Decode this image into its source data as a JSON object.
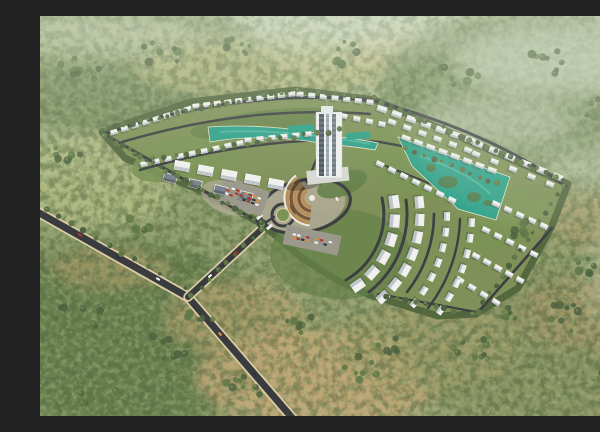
{
  "meta": {
    "description": "Aerial 3D rendering of a master-planned residential compound with curved rows of white villas and apartment blocks, a central high-rise tower, teal lagoon pools, a circular plaza with amphitheater, parking lots and an entrance road, surrounded by olive-green forest and tan clearings"
  },
  "palette": {
    "bg_top": "#c6d0b2",
    "bg_mid": "#8f9e6e",
    "bg_bot": "#99a172",
    "forest_dark": "#54683f",
    "forest_mid": "#74895a",
    "forest_light": "#a9b985",
    "mist": "#dde5d2",
    "road": "#393b3e",
    "road_int": "#3d3f42",
    "road_shoulder": "#dbcda6",
    "plot_base": "#7f9158",
    "lawn": "#65814a",
    "lawn_light": "#7a9455",
    "water": "#2da189",
    "island": "#4c7d4e",
    "water_streak": "#7fd0bd",
    "building": "#f0f1ee",
    "building_face": "#b9c0c8",
    "building_shadow": "#2e3430",
    "roof_gray": "#79828c",
    "roof_face": "#596169",
    "paving": "#b3ac99",
    "parking_asphalt": "#9b998c",
    "amphi_tan": "#b98e5a",
    "amphi_dark": "#7a5836",
    "amphi_rim": "#eeece0",
    "tower_light": "#eef1f2",
    "tower_dark": "#39414c",
    "tower_mid": "#8fa0ac",
    "tree_a": "#4d6340",
    "tree_b": "#5d7747",
    "tree_hi": "#7d9458",
    "stripe": "#b89a68",
    "cars": [
      "#f2f2f0",
      "#2e3338",
      "#b23427",
      "#d98f35",
      "#8a9096"
    ]
  },
  "scene": {
    "patches": [
      {
        "cx": 90,
        "cy": 55,
        "rx": 150,
        "ry": 65,
        "fill": "#74895a",
        "op": 0.9
      },
      {
        "cx": 55,
        "cy": 22,
        "rx": 130,
        "ry": 26,
        "fill": "#b7c093",
        "op": 0.65
      },
      {
        "cx": 225,
        "cy": 52,
        "rx": 130,
        "ry": 30,
        "fill": "#bdbd83",
        "op": 0.8
      },
      {
        "cx": 385,
        "cy": 38,
        "rx": 85,
        "ry": 22,
        "fill": "#c9bd84",
        "op": 0.6
      },
      {
        "cx": 490,
        "cy": 70,
        "rx": 150,
        "ry": 75,
        "fill": "#7d9263",
        "op": 0.9
      },
      {
        "cx": 55,
        "cy": 165,
        "rx": 85,
        "ry": 48,
        "fill": "#b5be85",
        "op": 0.85
      },
      {
        "cx": 85,
        "cy": 320,
        "rx": 150,
        "ry": 95,
        "fill": "#68804f",
        "op": 0.95
      },
      {
        "cx": 70,
        "cy": 252,
        "rx": 60,
        "ry": 22,
        "fill": "#c2a26e",
        "op": 0.5
      },
      {
        "cx": 280,
        "cy": 362,
        "rx": 125,
        "ry": 48,
        "fill": "#c6a877",
        "op": 0.85
      },
      {
        "cx": 195,
        "cy": 302,
        "rx": 70,
        "ry": 38,
        "fill": "#c9a874",
        "op": 0.6
      },
      {
        "cx": 500,
        "cy": 330,
        "rx": 135,
        "ry": 80,
        "fill": "#8a9364",
        "op": 0.85
      },
      {
        "cx": 548,
        "cy": 298,
        "rx": 70,
        "ry": 36,
        "fill": "#b59a6d",
        "op": 0.5
      },
      {
        "cx": 565,
        "cy": 205,
        "rx": 60,
        "ry": 32,
        "fill": "#b99a6a",
        "op": 0.45
      },
      {
        "cx": 295,
        "cy": 248,
        "rx": 60,
        "ry": 26,
        "fill": "#c2a26e",
        "op": 0.55
      },
      {
        "cx": 470,
        "cy": 230,
        "rx": 60,
        "ry": 30,
        "fill": "#9aa36f",
        "op": 0.6
      },
      {
        "cx": 390,
        "cy": 330,
        "rx": 90,
        "ry": 45,
        "fill": "#a5a06b",
        "op": 0.6
      }
    ],
    "mist": [
      {
        "cx": 520,
        "cy": 42,
        "rx": 110,
        "ry": 38,
        "op": 0.5
      },
      {
        "cx": 455,
        "cy": 108,
        "rx": 80,
        "ry": 26,
        "op": 0.38
      },
      {
        "cx": 560,
        "cy": 150,
        "rx": 60,
        "ry": 22,
        "op": 0.3
      },
      {
        "cx": 300,
        "cy": 20,
        "rx": 120,
        "ry": 22,
        "op": 0.35
      },
      {
        "cx": 80,
        "cy": 18,
        "rx": 90,
        "ry": 16,
        "op": 0.3
      },
      {
        "cx": 585,
        "cy": 260,
        "rx": 40,
        "ry": 60,
        "op": 0.25
      }
    ],
    "stripes": {
      "x1": 198,
      "y1": 334,
      "x2": 316,
      "y2": 356,
      "n": 12,
      "dx": 14,
      "dy": 38
    },
    "roads_external": [
      {
        "d": "M-6,194 L148,281 L254,404",
        "w": 7
      },
      {
        "d": "M148,281 L226,209",
        "w": 6
      }
    ],
    "plot": {
      "points": [
        [
          62,
          116
        ],
        [
          150,
          86
        ],
        [
          255,
          74
        ],
        [
          335,
          84
        ],
        [
          455,
          136
        ],
        [
          528,
          168
        ],
        [
          512,
          210
        ],
        [
          478,
          272
        ],
        [
          436,
          298
        ],
        [
          398,
          300
        ],
        [
          330,
          279
        ],
        [
          300,
          266
        ],
        [
          262,
          242
        ],
        [
          222,
          208
        ],
        [
          155,
          172
        ],
        [
          120,
          158
        ],
        [
          85,
          142
        ]
      ]
    },
    "tints": [
      {
        "cx": 150,
        "cy": 140,
        "rx": 60,
        "ry": 22,
        "rot": -15,
        "fill": "lawn_light",
        "op": 0.9
      },
      {
        "cx": 230,
        "cy": 108,
        "rx": 80,
        "ry": 14,
        "rot": -6,
        "fill": "lawn",
        "op": 0.8
      },
      {
        "cx": 380,
        "cy": 150,
        "rx": 70,
        "ry": 30,
        "rot": 20,
        "fill": "lawn_light",
        "op": 0.8
      },
      {
        "cx": 300,
        "cy": 238,
        "rx": 70,
        "ry": 45,
        "rot": 0,
        "fill": "lawn",
        "op": 0.7
      },
      {
        "cx": 455,
        "cy": 205,
        "rx": 45,
        "ry": 28,
        "rot": -35,
        "fill": "lawn_light",
        "op": 0.7
      },
      {
        "cx": 262,
        "cy": 190,
        "rx": 44,
        "ry": 26,
        "rot": -12,
        "fill": "paving",
        "op": 0.85
      },
      {
        "cx": 190,
        "cy": 182,
        "rx": 30,
        "ry": 16,
        "rot": 18,
        "fill": "paving",
        "op": 0.7
      },
      {
        "cx": 302,
        "cy": 168,
        "rx": 26,
        "ry": 12,
        "rot": -20,
        "fill": "lawn",
        "op": 0.9
      }
    ],
    "roads_internal": [
      {
        "type": "path",
        "d": "M64,118 C150,88 240,76 332,84 C420,108 480,138 526,170",
        "w": 3
      },
      {
        "type": "path",
        "d": "M82,126 C170,100 250,92 330,98",
        "w": 2.4
      },
      {
        "type": "path",
        "d": "M100,154 C190,128 272,120 340,126 C390,134 440,152 468,166",
        "w": 2.4
      },
      {
        "type": "path",
        "d": "M222,208 L64,118",
        "w": 3
      },
      {
        "type": "ellipse",
        "cx": 265,
        "cy": 190,
        "rx": 46,
        "ry": 26,
        "rot": -12,
        "w": 3.2
      },
      {
        "type": "circle",
        "cx": 243,
        "cy": 199,
        "r": 11,
        "w": 3
      },
      {
        "type": "path",
        "d": "M225,207 L234,201",
        "w": 2.4
      },
      {
        "type": "path",
        "d": "M267,166 L277,142",
        "w": 2.4
      },
      {
        "type": "path",
        "d": "M342,182 A76,76 0 0 1 306,264",
        "w": 3
      },
      {
        "type": "path",
        "d": "M366,184 A99,99 0 0 1 329,276",
        "w": 3
      },
      {
        "type": "path",
        "d": "M394,198 A126,126 0 0 1 367,276",
        "w": 2.6
      },
      {
        "type": "path",
        "d": "M420,203 A152,152 0 0 1 388,292",
        "w": 2.4
      },
      {
        "type": "path",
        "d": "M360,124 L466,162",
        "w": 2.2
      },
      {
        "type": "path",
        "d": "M346,150 L446,190",
        "w": 2.2
      },
      {
        "type": "path",
        "d": "M512,212 L440,294",
        "w": 2.6
      },
      {
        "type": "path",
        "d": "M436,296 L338,278",
        "w": 2.2
      }
    ],
    "lagoons": [
      {
        "d": "M168,111 C210,108 252,112 280,118 C302,122 322,123 338,127 L335,134 C312,130 292,129 274,126 C242,121 202,120 170,126 Z"
      },
      {
        "d": "M358,121 L470,161 L456,204 L418,193 L372,150 Z"
      }
    ],
    "islands": [
      [
        408,
        166,
        10,
        6
      ],
      [
        434,
        181,
        7,
        5
      ],
      [
        391,
        152,
        5,
        4
      ],
      [
        448,
        187,
        5,
        3
      ]
    ],
    "streaks": [
      {
        "d": "M180,116 C230,113 290,120 330,128"
      },
      {
        "d": "M380,140 C410,150 435,162 450,178"
      }
    ],
    "pools": [
      [
        248,
        110,
        26,
        7,
        -4
      ],
      [
        306,
        117,
        24,
        7,
        -4
      ]
    ],
    "amphitheater": {
      "cx": 272,
      "cy": 182,
      "radii": [
        9,
        13,
        17,
        21,
        25
      ],
      "rim": 27.5,
      "a1": 95,
      "a2": 235
    },
    "roundabout": {
      "cx": 243,
      "cy": 199,
      "r_outer": 11,
      "r_inner": 6.5
    },
    "gate": {
      "rects": [
        [
          216,
          202,
          7,
          3,
          -40
        ],
        [
          226,
          212,
          7,
          3,
          -40
        ]
      ],
      "circle": [
        222,
        208,
        4
      ]
    },
    "parkings": [
      {
        "cx": 203,
        "cy": 180,
        "w": 48,
        "h": 26,
        "rot": 20,
        "rows": 3,
        "cols": 8
      },
      {
        "cx": 272,
        "cy": 224,
        "w": 56,
        "h": 20,
        "rot": 12,
        "rows": 2,
        "cols": 9
      }
    ],
    "building_rows": [
      {
        "x1": 74,
        "y1": 116,
        "x2": 148,
        "y2": 93,
        "n": 8,
        "w": 7,
        "h": 5
      },
      {
        "x1": 156,
        "y1": 90,
        "x2": 252,
        "y2": 78,
        "n": 10,
        "w": 7,
        "h": 5
      },
      {
        "x1": 260,
        "y1": 78,
        "x2": 330,
        "y2": 86,
        "n": 7,
        "w": 7,
        "h": 5
      },
      {
        "x1": 304,
        "y1": 100,
        "x2": 342,
        "y2": 108,
        "n": 4,
        "w": 7,
        "h": 5
      },
      {
        "x1": 342,
        "y1": 93,
        "x2": 430,
        "y2": 124,
        "n": 7,
        "w": 10,
        "h": 6
      },
      {
        "x1": 438,
        "y1": 128,
        "x2": 518,
        "y2": 161,
        "n": 6,
        "w": 10,
        "h": 6
      },
      {
        "x1": 352,
        "y1": 106,
        "x2": 428,
        "y2": 134,
        "n": 6,
        "w": 8,
        "h": 5
      },
      {
        "x1": 436,
        "y1": 138,
        "x2": 510,
        "y2": 168,
        "n": 5,
        "w": 8,
        "h": 5
      },
      {
        "x1": 104,
        "y1": 148,
        "x2": 200,
        "y2": 127,
        "n": 9,
        "w": 7,
        "h": 5
      },
      {
        "x1": 208,
        "y1": 124,
        "x2": 268,
        "y2": 118,
        "n": 6,
        "w": 7,
        "h": 5
      },
      {
        "x1": 366,
        "y1": 122,
        "x2": 452,
        "y2": 154,
        "n": 8,
        "w": 9,
        "h": 5
      },
      {
        "x1": 340,
        "y1": 148,
        "x2": 412,
        "y2": 184,
        "n": 7,
        "w": 8,
        "h": 5
      },
      {
        "x1": 456,
        "y1": 188,
        "x2": 504,
        "y2": 210,
        "n": 5,
        "w": 8,
        "h": 5
      },
      {
        "x1": 446,
        "y1": 214,
        "x2": 494,
        "y2": 238,
        "n": 5,
        "w": 8,
        "h": 5
      },
      {
        "x1": 436,
        "y1": 240,
        "x2": 480,
        "y2": 264,
        "n": 5,
        "w": 8,
        "h": 5
      },
      {
        "x1": 420,
        "y1": 264,
        "x2": 456,
        "y2": 286,
        "n": 4,
        "w": 8,
        "h": 5
      },
      {
        "x1": 142,
        "y1": 150,
        "x2": 236,
        "y2": 168,
        "n": 5,
        "w": 15,
        "h": 9,
        "fill": "building",
        "rim": true
      },
      {
        "x1": 130,
        "y1": 162,
        "x2": 206,
        "y2": 180,
        "n": 4,
        "w": 13,
        "h": 8,
        "fill": "roof",
        "rim": true
      }
    ],
    "building_arcs": {
      "cx": 268,
      "cy": 198,
      "arcs": [
        {
          "r": 87,
          "a1": -8,
          "a2": 55,
          "n": 6,
          "w": 13,
          "h": 10
        },
        {
          "r": 112,
          "a1": -6,
          "a2": 48,
          "n": 7,
          "w": 12,
          "h": 9
        },
        {
          "r": 139,
          "a1": 1,
          "a2": 40,
          "n": 7,
          "w": 8.5,
          "h": 6
        },
        {
          "r": 164,
          "a1": 3,
          "a2": 36,
          "n": 7,
          "w": 8.5,
          "h": 6
        }
      ]
    },
    "tower": {
      "x": 276,
      "y": 96,
      "w": 26,
      "h": 66
    },
    "treelines": [
      {
        "x1": 64,
        "y1": 120,
        "x2": 220,
        "y2": 206,
        "n": 26
      },
      {
        "x1": 66,
        "y1": 112,
        "x2": 250,
        "y2": 74,
        "n": 22
      },
      {
        "x1": 258,
        "y1": 74,
        "x2": 334,
        "y2": 82,
        "n": 9
      },
      {
        "x1": 342,
        "y1": 86,
        "x2": 524,
        "y2": 164,
        "n": 22
      },
      {
        "x1": 524,
        "y1": 170,
        "x2": 438,
        "y2": 296,
        "n": 15
      },
      {
        "x1": 434,
        "y1": 298,
        "x2": 336,
        "y2": 278,
        "n": 11
      },
      {
        "x1": 112,
        "y1": 142,
        "x2": 300,
        "y2": 114,
        "n": 17
      },
      {
        "x1": 366,
        "y1": 132,
        "x2": 458,
        "y2": 168,
        "n": 11
      },
      {
        "x1": 222,
        "y1": 212,
        "x2": 152,
        "y2": 280,
        "n": 9
      },
      {
        "x1": 6,
        "y1": 194,
        "x2": 146,
        "y2": 272,
        "n": 12
      }
    ],
    "clusters": [
      [
        38,
        58,
        24,
        10
      ],
      [
        120,
        38,
        20,
        8
      ],
      [
        198,
        28,
        16,
        7
      ],
      [
        305,
        36,
        18,
        7
      ],
      [
        420,
        58,
        22,
        8
      ],
      [
        505,
        46,
        20,
        8
      ],
      [
        562,
        92,
        18,
        7
      ],
      [
        28,
        140,
        18,
        7
      ],
      [
        95,
        212,
        16,
        6
      ],
      [
        36,
        300,
        26,
        10
      ],
      [
        125,
        332,
        22,
        9
      ],
      [
        205,
        372,
        20,
        8
      ],
      [
        322,
        352,
        18,
        7
      ],
      [
        428,
        332,
        20,
        8
      ],
      [
        522,
        302,
        22,
        9
      ],
      [
        566,
        362,
        18,
        7
      ],
      [
        480,
        212,
        13,
        6
      ],
      [
        572,
        152,
        13,
        6
      ],
      [
        258,
        306,
        16,
        7
      ],
      [
        350,
        330,
        15,
        6
      ],
      [
        60,
        380,
        20,
        8
      ],
      [
        160,
        300,
        14,
        6
      ],
      [
        470,
        300,
        14,
        6
      ],
      [
        545,
        250,
        13,
        6
      ]
    ],
    "road_cars": [
      {
        "x": 40,
        "y": 219,
        "rot": 29,
        "c": 2
      },
      {
        "x": 78,
        "y": 241,
        "rot": 29,
        "c": 1
      },
      {
        "x": 118,
        "y": 263,
        "rot": 29,
        "c": 0
      },
      {
        "x": 180,
        "y": 318,
        "rot": 49,
        "c": 3
      },
      {
        "x": 215,
        "y": 358,
        "rot": 49,
        "c": 1
      },
      {
        "x": 170,
        "y": 260,
        "rot": -43,
        "c": 0
      },
      {
        "x": 196,
        "y": 237,
        "rot": -43,
        "c": 2
      },
      {
        "x": 250,
        "y": 214,
        "rot": 12,
        "c": 4
      },
      {
        "x": 297,
        "y": 183,
        "rot": 60,
        "c": 0
      }
    ]
  }
}
